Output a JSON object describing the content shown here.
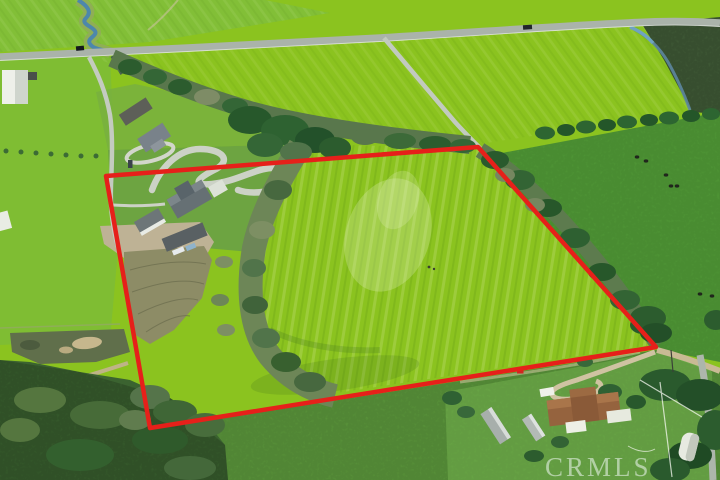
{
  "watermark": {
    "text": "CRMLS",
    "color": "rgba(242,249,245,0.55)"
  },
  "boundary": {
    "color": "#e6201a",
    "points": "106,176 478,147 656,347 150,428",
    "stroke_width": "4.5"
  },
  "palette": {
    "parcel_field": "#8bc31f",
    "left_fields": "#7fbd33",
    "right_pasture": "#54a039",
    "rough_pasture": "#5f9d3e",
    "woods": "#3b6330",
    "dark_crop_rows": "#1d4e2a",
    "paved_road": "#aab3aa",
    "dirt_road": "#c9ba94",
    "creek_water": "#4d87ab",
    "tilled_soil": "#8d8c66"
  }
}
